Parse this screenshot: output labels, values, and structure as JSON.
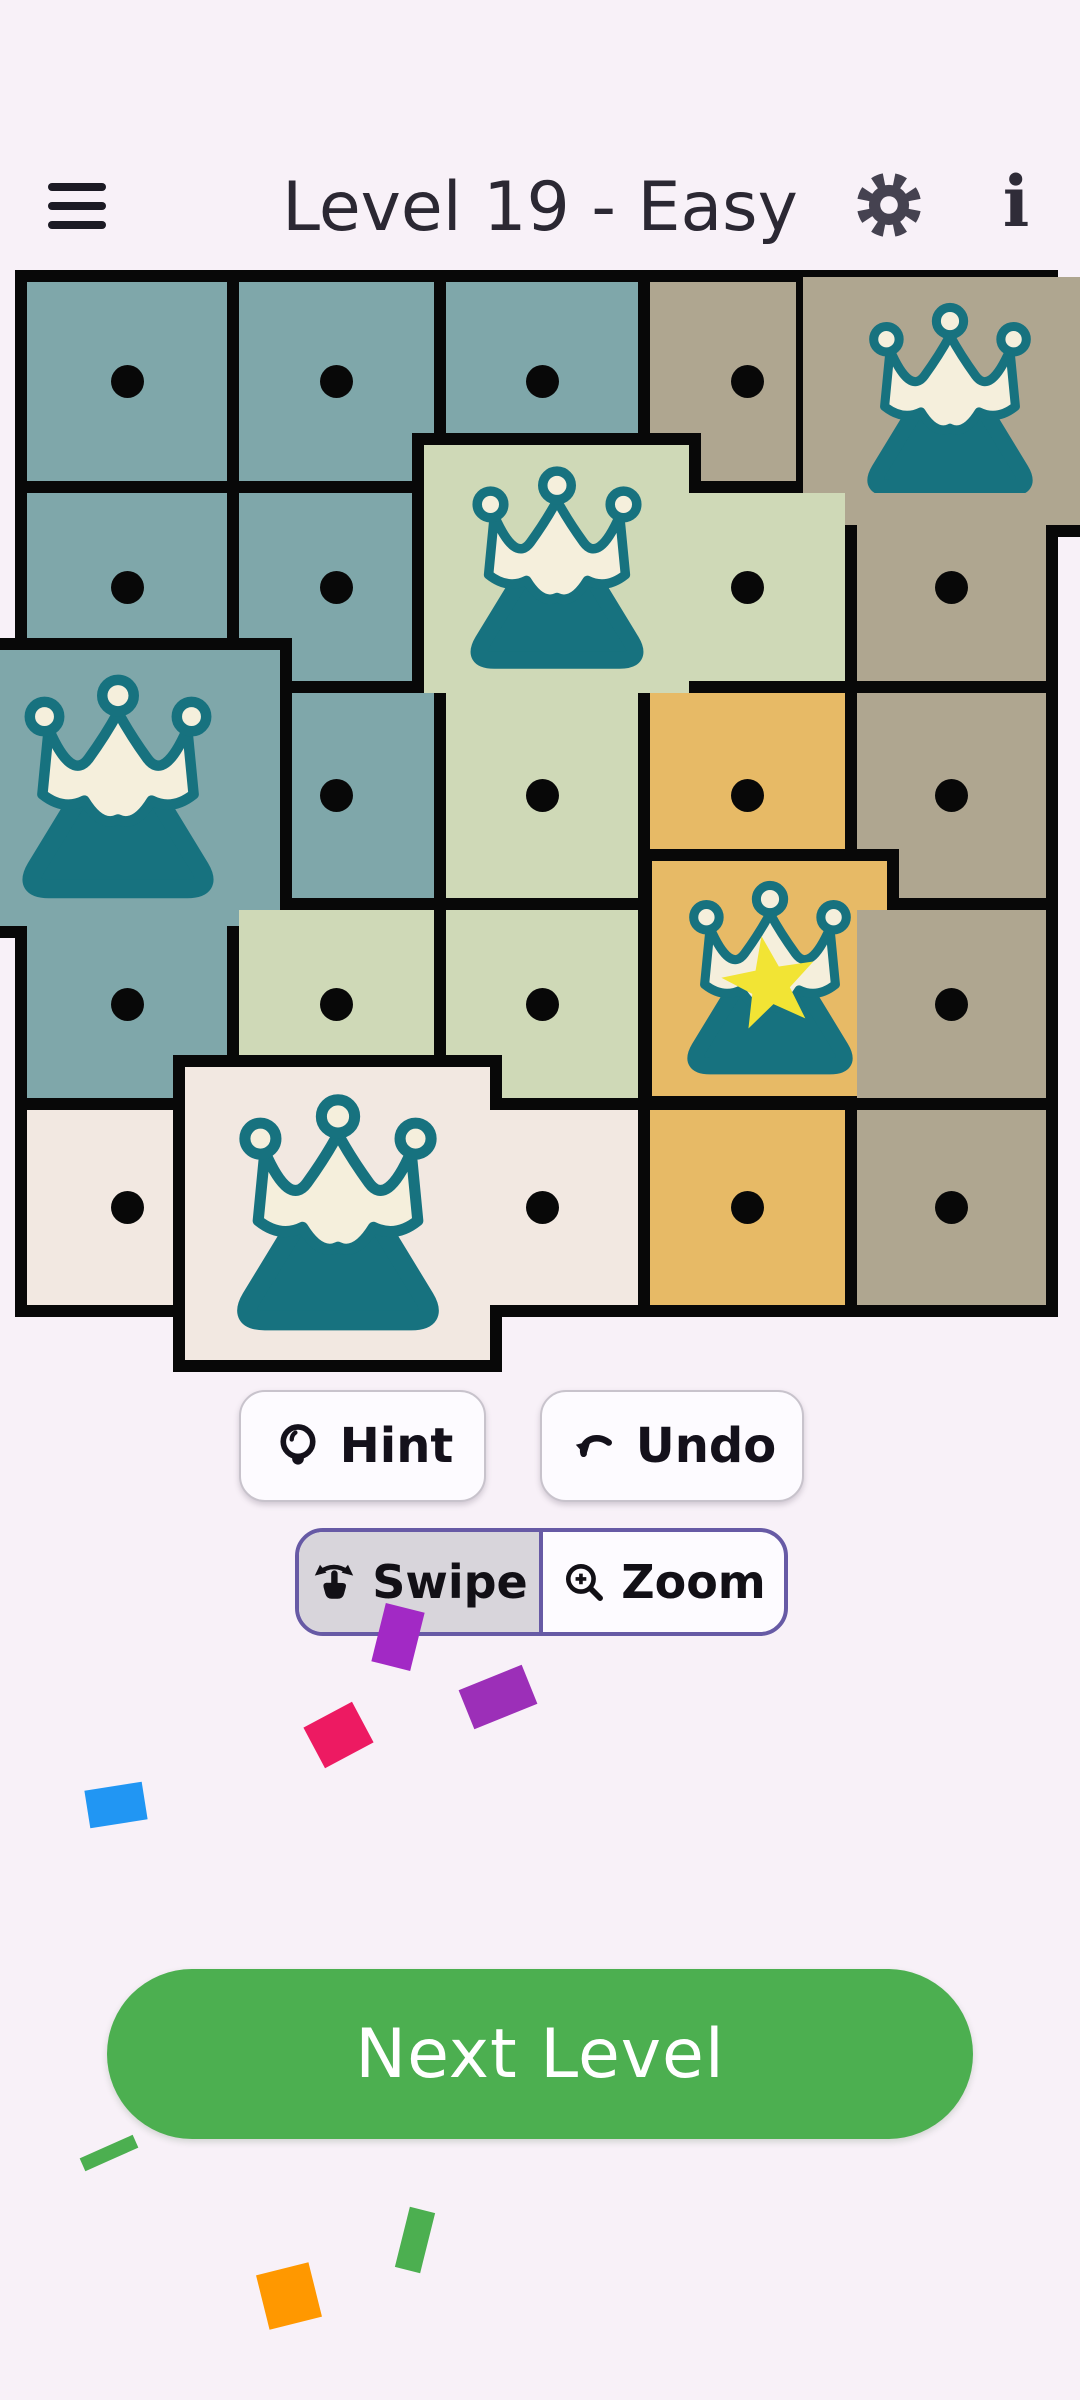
{
  "header": {
    "title": "Level 19 - Easy"
  },
  "board": {
    "origin": {
      "x": 15,
      "y": 270,
      "width": 1043,
      "height": 1047
    },
    "grid_color": "#080808",
    "palette": {
      "teal": "#7FA7AA",
      "sage": "#CFD9B7",
      "tan": "#AFA690",
      "orange": "#E7BA66",
      "cream": "#F2E8E1"
    },
    "icon_colors": {
      "mountain": "#17727F",
      "crown": "#F5EFDC",
      "star": "#F2E434",
      "dot": "#080808"
    },
    "cells": [
      {
        "id": "r1c1",
        "row": 1,
        "col": 1,
        "color": "teal",
        "mark": "dot",
        "x": 12,
        "y": 12,
        "w": 200,
        "h": 199,
        "z": 1
      },
      {
        "id": "r1c2",
        "row": 1,
        "col": 2,
        "color": "teal",
        "mark": "dot",
        "x": 224,
        "y": 12,
        "w": 195,
        "h": 199,
        "z": 2
      },
      {
        "id": "r1c3",
        "row": 1,
        "col": 3,
        "color": "teal",
        "mark": "dot",
        "x": 431,
        "y": 12,
        "w": 192,
        "h": 199,
        "z": 3
      },
      {
        "id": "r1c4",
        "row": 1,
        "col": 4,
        "color": "tan",
        "mark": "dot",
        "x": 635,
        "y": 12,
        "w": 195,
        "h": 199,
        "z": 4
      },
      {
        "id": "r1c5",
        "row": 1,
        "col": 5,
        "color": "tan",
        "mark": "crown",
        "x": 781,
        "y": 7,
        "w": 300,
        "h": 260,
        "z": 5,
        "pop": true,
        "bw": "0px 0px 12px 7px"
      },
      {
        "id": "r2c1",
        "row": 2,
        "col": 1,
        "color": "teal",
        "mark": "dot",
        "x": 12,
        "y": 223,
        "w": 200,
        "h": 188,
        "z": 6
      },
      {
        "id": "r2c2",
        "row": 2,
        "col": 2,
        "color": "teal",
        "mark": "dot",
        "x": 224,
        "y": 223,
        "w": 195,
        "h": 188,
        "z": 7
      },
      {
        "id": "r2c3",
        "row": 2,
        "col": 3,
        "color": "sage",
        "mark": "crown",
        "x": 397,
        "y": 163,
        "w": 289,
        "h": 272,
        "z": 8,
        "pop": true,
        "bw": "12px"
      },
      {
        "id": "r2c4",
        "row": 2,
        "col": 4,
        "color": "sage",
        "mark": "dot",
        "x": 635,
        "y": 223,
        "w": 195,
        "h": 188,
        "z": 9
      },
      {
        "id": "r2c5",
        "row": 2,
        "col": 5,
        "color": "tan",
        "mark": "dot",
        "x": 842,
        "y": 223,
        "w": 189,
        "h": 188,
        "z": 10
      },
      {
        "id": "r3c2",
        "row": 3,
        "col": 2,
        "color": "teal",
        "mark": "dot",
        "x": 224,
        "y": 423,
        "w": 195,
        "h": 205,
        "z": 12
      },
      {
        "id": "r3c1",
        "row": 3,
        "col": 1,
        "color": "teal",
        "mark": "crown",
        "x": -60,
        "y": 368,
        "w": 337,
        "h": 300,
        "z": 13,
        "pop": true,
        "bw": "12px 12px 12px 0px"
      },
      {
        "id": "r3c3",
        "row": 3,
        "col": 3,
        "color": "sage",
        "mark": "dot",
        "x": 431,
        "y": 423,
        "w": 192,
        "h": 205,
        "z": 14
      },
      {
        "id": "r3c4",
        "row": 3,
        "col": 4,
        "color": "orange",
        "mark": "dot",
        "x": 635,
        "y": 423,
        "w": 195,
        "h": 205,
        "z": 15
      },
      {
        "id": "r3c5",
        "row": 3,
        "col": 5,
        "color": "tan",
        "mark": "dot",
        "x": 842,
        "y": 423,
        "w": 189,
        "h": 205,
        "z": 16
      },
      {
        "id": "r4c1",
        "row": 4,
        "col": 1,
        "color": "teal",
        "mark": "dot",
        "x": 12,
        "y": 640,
        "w": 200,
        "h": 188,
        "z": 17
      },
      {
        "id": "r4c2",
        "row": 4,
        "col": 2,
        "color": "sage",
        "mark": "dot",
        "x": 224,
        "y": 640,
        "w": 195,
        "h": 188,
        "z": 18
      },
      {
        "id": "r4c3",
        "row": 4,
        "col": 3,
        "color": "sage",
        "mark": "dot",
        "x": 431,
        "y": 640,
        "w": 192,
        "h": 188,
        "z": 19
      },
      {
        "id": "r4c4",
        "row": 4,
        "col": 4,
        "color": "orange",
        "mark": "crown-star",
        "x": 625,
        "y": 579,
        "w": 259,
        "h": 259,
        "z": 20,
        "pop": true,
        "bw": "12px"
      },
      {
        "id": "r4c5",
        "row": 4,
        "col": 5,
        "color": "tan",
        "mark": "dot",
        "x": 842,
        "y": 640,
        "w": 189,
        "h": 188,
        "z": 21
      },
      {
        "id": "r5c1",
        "row": 5,
        "col": 1,
        "color": "cream",
        "mark": "dot",
        "x": 12,
        "y": 840,
        "w": 200,
        "h": 195,
        "z": 22
      },
      {
        "id": "r5c2",
        "row": 5,
        "col": 2,
        "color": "cream",
        "mark": "crown",
        "x": 158,
        "y": 785,
        "w": 329,
        "h": 317,
        "z": 23,
        "pop": true,
        "bw": "12px"
      },
      {
        "id": "r5c3",
        "row": 5,
        "col": 3,
        "color": "cream",
        "mark": "dot",
        "x": 431,
        "y": 840,
        "w": 192,
        "h": 195,
        "z": 24
      },
      {
        "id": "r5c4",
        "row": 5,
        "col": 4,
        "color": "orange",
        "mark": "dot",
        "x": 635,
        "y": 840,
        "w": 195,
        "h": 195,
        "z": 25
      },
      {
        "id": "r5c5",
        "row": 5,
        "col": 5,
        "color": "tan",
        "mark": "dot",
        "x": 842,
        "y": 840,
        "w": 189,
        "h": 195,
        "z": 26
      }
    ]
  },
  "toolbar": {
    "hint_label": "Hint",
    "undo_label": "Undo"
  },
  "mode_toggle": {
    "accent": "#675AA5",
    "options": [
      {
        "label": "Swipe",
        "selected": true
      },
      {
        "label": "Zoom",
        "selected": false
      }
    ]
  },
  "next_button": {
    "label": "Next Level",
    "color": "#4CAF50"
  },
  "confetti": [
    {
      "x": 378,
      "y": 1607,
      "w": 40,
      "h": 60,
      "rot": 14,
      "color": "#A229C5"
    },
    {
      "x": 464,
      "y": 1676,
      "w": 68,
      "h": 42,
      "rot": -22,
      "color": "#9C2FB8"
    },
    {
      "x": 311,
      "y": 1712,
      "w": 55,
      "h": 46,
      "rot": -28,
      "color": "#ED1A62"
    },
    {
      "x": 87,
      "y": 1786,
      "w": 58,
      "h": 38,
      "rot": -9,
      "color": "#2196F3"
    },
    {
      "x": 80,
      "y": 2146,
      "w": 58,
      "h": 14,
      "rot": -24,
      "color": "#4CAF50"
    },
    {
      "x": 402,
      "y": 2209,
      "w": 26,
      "h": 62,
      "rot": 14,
      "color": "#4CAF50"
    },
    {
      "x": 262,
      "y": 2268,
      "w": 54,
      "h": 56,
      "rot": -14,
      "color": "#FF9800"
    }
  ]
}
